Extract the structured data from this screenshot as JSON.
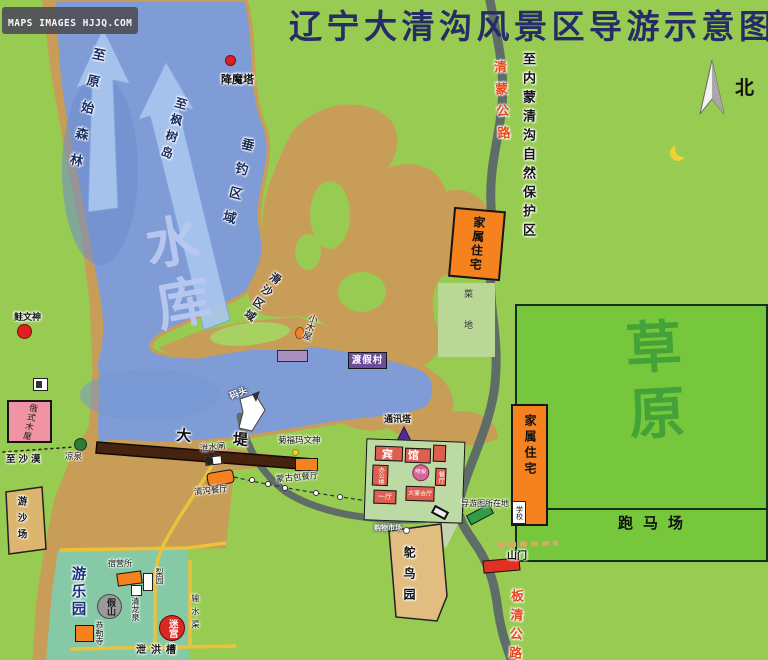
{
  "watermark": "MAPS IMAGES HJJQ.COM",
  "title": "辽宁大清沟风景区导游示意图",
  "compass_north": "北",
  "lake": {
    "name": "水库",
    "to_primitive_forest": "至原始森林",
    "to_maple_island": "至枫树岛",
    "fishing_zone": "垂钓区域",
    "sand_slide_zone": "滑沙区域",
    "dock": "码头"
  },
  "roads": {
    "qingmeng_highway": "清蒙公路",
    "to_inner_mongolia_reserve": "至内蒙清沟自然保护区",
    "banqing_highway": "板清公路",
    "to_desert": "至沙漠",
    "dam": "大堤",
    "sluice_gate": "泄水闸",
    "flood_channel": "泄洪槽",
    "water_channel": "输水渠",
    "mountain_gate": "山门"
  },
  "places": {
    "xiangmo_tower": "降魔塔",
    "family_residence_north": "家属住宅",
    "vegetable_field": "菜地",
    "grassland": "草原",
    "horse_track": "跑马场",
    "log_cabin": "小木屋",
    "resort_village": "渡假村",
    "comm_tower": "通讯塔",
    "fish_totem": "鲑文神",
    "russian_cabin": "俄式木屋",
    "cool_spring": "凉泉",
    "qinggou_restaurant": "清沟餐厅",
    "mawenshen": "菊福玛文神",
    "yurt_restaurant": "蒙古包餐厅",
    "guide_map_location": "导游图所在地",
    "school": "学校",
    "family_residence_east": "家属住宅",
    "ostrich_park": "鸵鸟园",
    "shopping_market": "购物市场",
    "sand_playground": "游沙场",
    "amusement_park": "游乐园",
    "camp_office": "宿营所",
    "pear_garden": "梨园",
    "rockery_hill": "假山",
    "qinglong_spring": "清龙泉",
    "gonglei_temple": "恭勒寺",
    "maze": "迷宫"
  },
  "hotel": {
    "name": "宾馆",
    "office": "办公楼",
    "fountain": "喷泉",
    "dining_hall": "餐厅",
    "hall_one": "一厅",
    "banquet_hall": "大宴会厅"
  },
  "colors": {
    "background_green": "#98cb51",
    "grassland_green": "#76c73c",
    "lake_blue": "#7f9cd6",
    "sand_tan": "#c79d58",
    "road_gray": "#5e6d68",
    "building_orange": "#f5821f",
    "highway_label_red": "#e8481a",
    "title_navy": "#252c66"
  }
}
